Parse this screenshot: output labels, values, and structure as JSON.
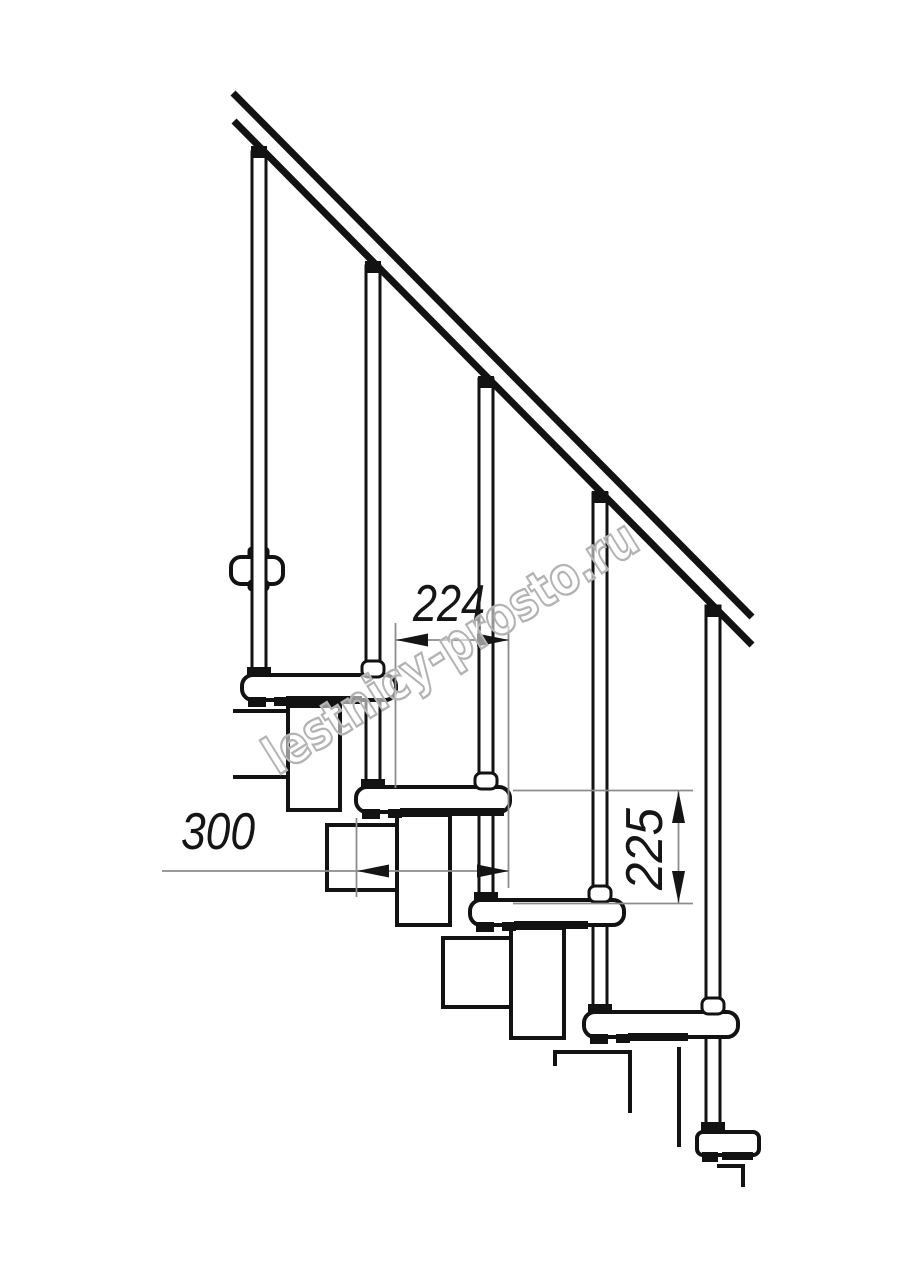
{
  "drawing": {
    "watermark": "lestnicy-prosto.ru",
    "dimensions": {
      "run_between_steps": "224",
      "tread_depth": "300",
      "riser_height": "225"
    },
    "colors": {
      "line": "#121212",
      "dimension_line": "#8c8c8c",
      "dimension_text": "#151515",
      "watermark_outline": "#b3b3b3",
      "background": "#ffffff"
    }
  }
}
